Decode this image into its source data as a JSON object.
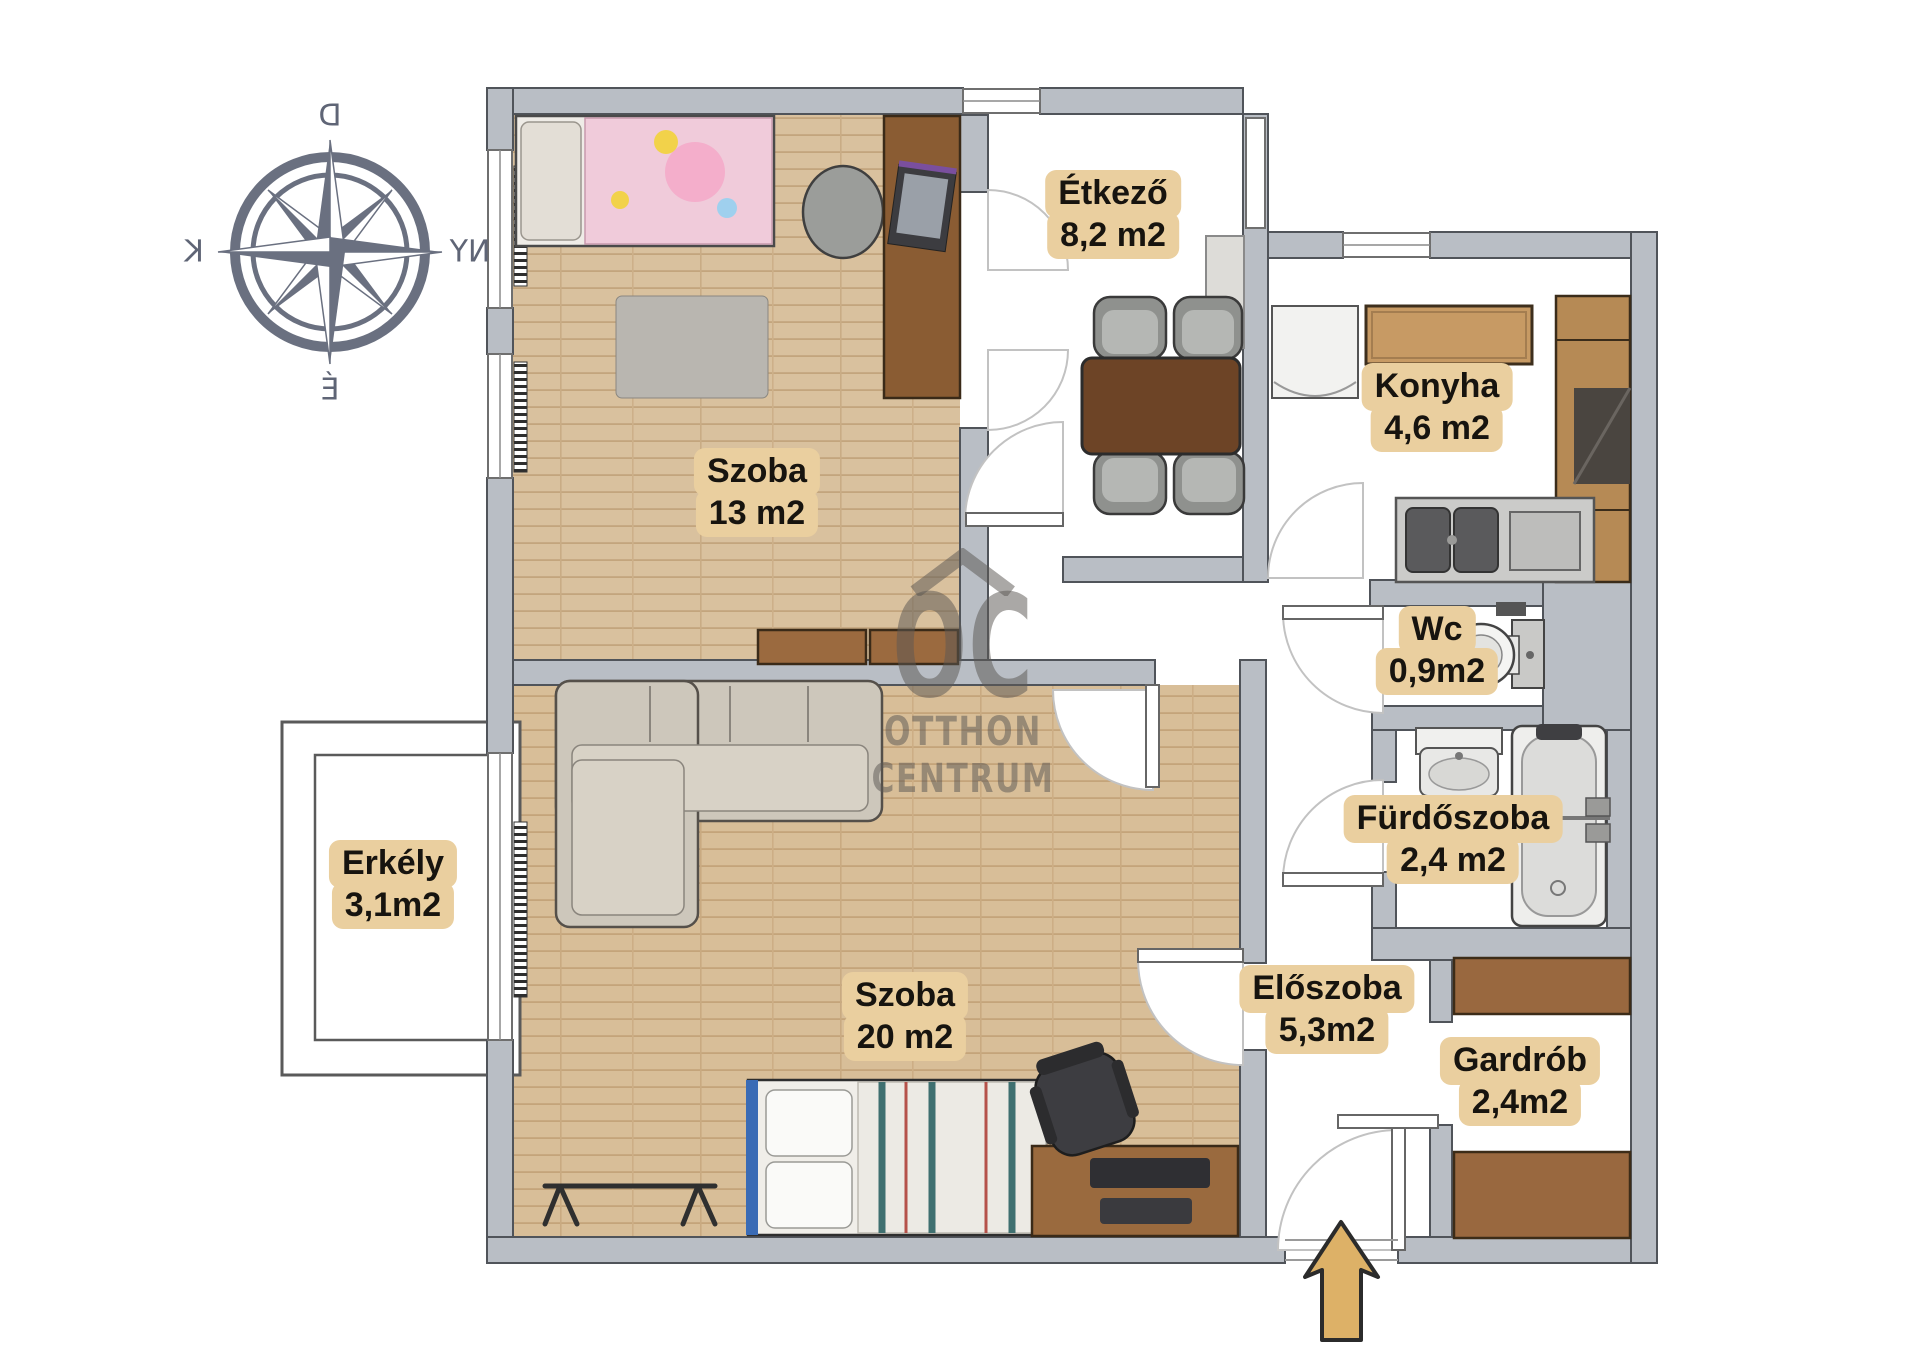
{
  "compass": {
    "top": "D",
    "left": "K",
    "right": "NY",
    "bottom": "É"
  },
  "watermark": {
    "logo": "OC",
    "line1": "OTTHON",
    "line2": "CENTRUM"
  },
  "rooms": [
    {
      "id": "szoba13",
      "name": "Szoba",
      "area": "13 m2"
    },
    {
      "id": "etkezo",
      "name": "Étkező",
      "area": "8,2 m2"
    },
    {
      "id": "konyha",
      "name": "Konyha",
      "area": "4,6 m2"
    },
    {
      "id": "wc",
      "name": "Wc",
      "area": "0,9m2"
    },
    {
      "id": "furdoszoba",
      "name": "Fürdőszoba",
      "area": "2,4 m2"
    },
    {
      "id": "szoba20",
      "name": "Szoba",
      "area": "20 m2"
    },
    {
      "id": "eloszoba",
      "name": "Előszoba",
      "area": "5,3m2"
    },
    {
      "id": "gardrob",
      "name": "Gardrób",
      "area": "2,4m2"
    },
    {
      "id": "erkely",
      "name": "Erkély",
      "area": "3,1m2"
    }
  ],
  "colors": {
    "wall": "#b9bec5",
    "wall_stroke": "#50545a",
    "label_bg": "#eacf9f",
    "label_text": "#17140f",
    "compass": "#6a7080",
    "arrow_fill": "#ddb167",
    "arrow_stroke": "#2b2b2b",
    "wood_floor": "#d9c19e"
  }
}
